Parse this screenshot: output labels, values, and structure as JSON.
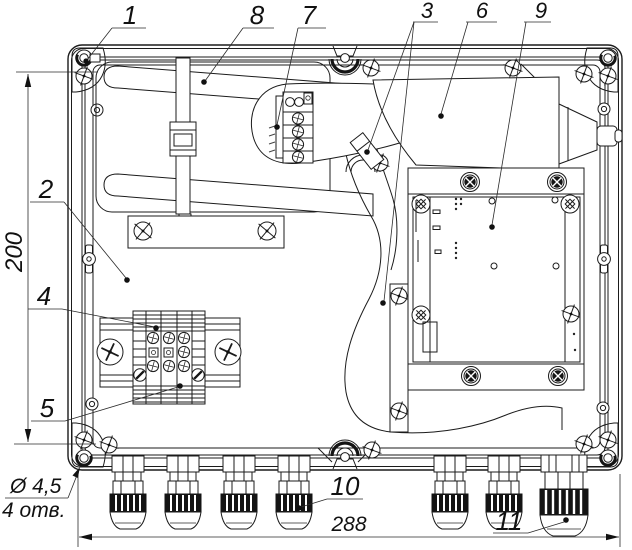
{
  "callouts": [
    {
      "label": "1"
    },
    {
      "label": "2"
    },
    {
      "label": "3"
    },
    {
      "label": "4"
    },
    {
      "label": "5"
    },
    {
      "label": "6"
    },
    {
      "label": "7"
    },
    {
      "label": "8"
    },
    {
      "label": "9"
    },
    {
      "label": "10"
    },
    {
      "label": "11"
    }
  ],
  "dimensions": {
    "height_label": "200",
    "width_label": "288",
    "hole_diameter": "Ø 4,5",
    "hole_count": "4 отв."
  },
  "colors": {
    "line": "#1b1b1b",
    "background": "#ffffff"
  }
}
